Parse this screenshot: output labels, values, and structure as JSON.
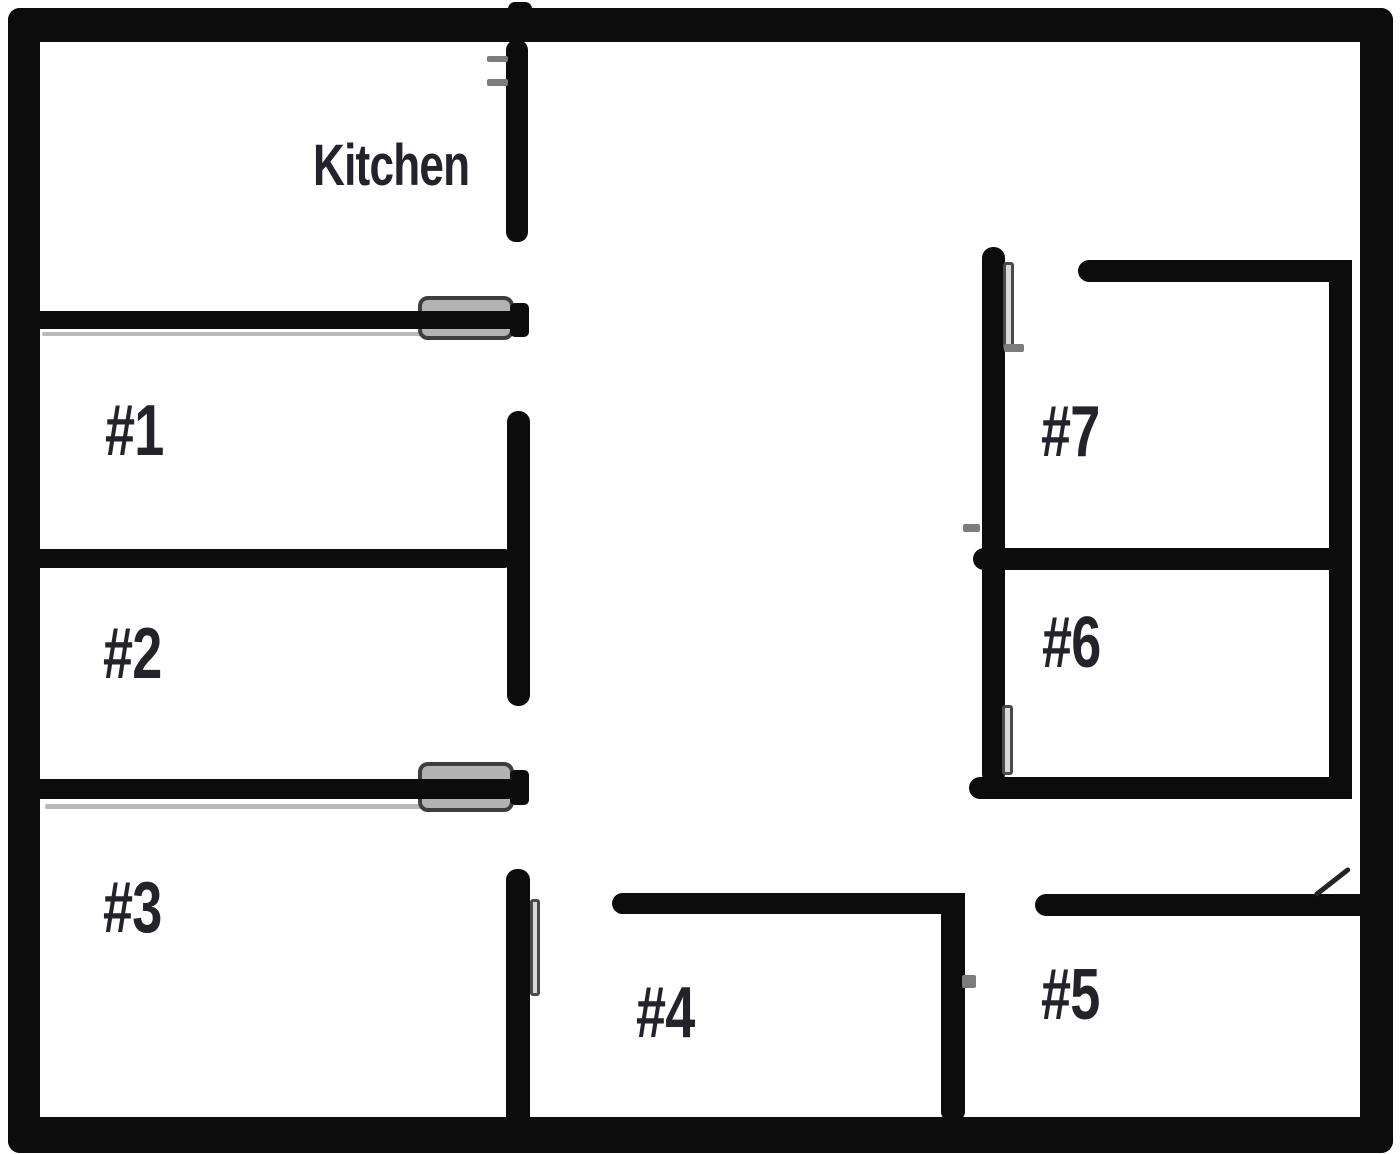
{
  "floorplan": {
    "title": "Apartment floor plan",
    "rooms": [
      {
        "id": "kitchen",
        "label": "Kitchen"
      },
      {
        "id": "room-1",
        "label": "#1"
      },
      {
        "id": "room-2",
        "label": "#2"
      },
      {
        "id": "room-3",
        "label": "#3"
      },
      {
        "id": "room-4",
        "label": "#4"
      },
      {
        "id": "room-5",
        "label": "#5"
      },
      {
        "id": "room-6",
        "label": "#6"
      },
      {
        "id": "room-7",
        "label": "#7"
      }
    ],
    "colors": {
      "wall": "#0c0c0c",
      "door_fill": "#b3b3b3",
      "door_border": "#3e3e3e",
      "label": "#23232b",
      "background": "#ffffff"
    }
  }
}
